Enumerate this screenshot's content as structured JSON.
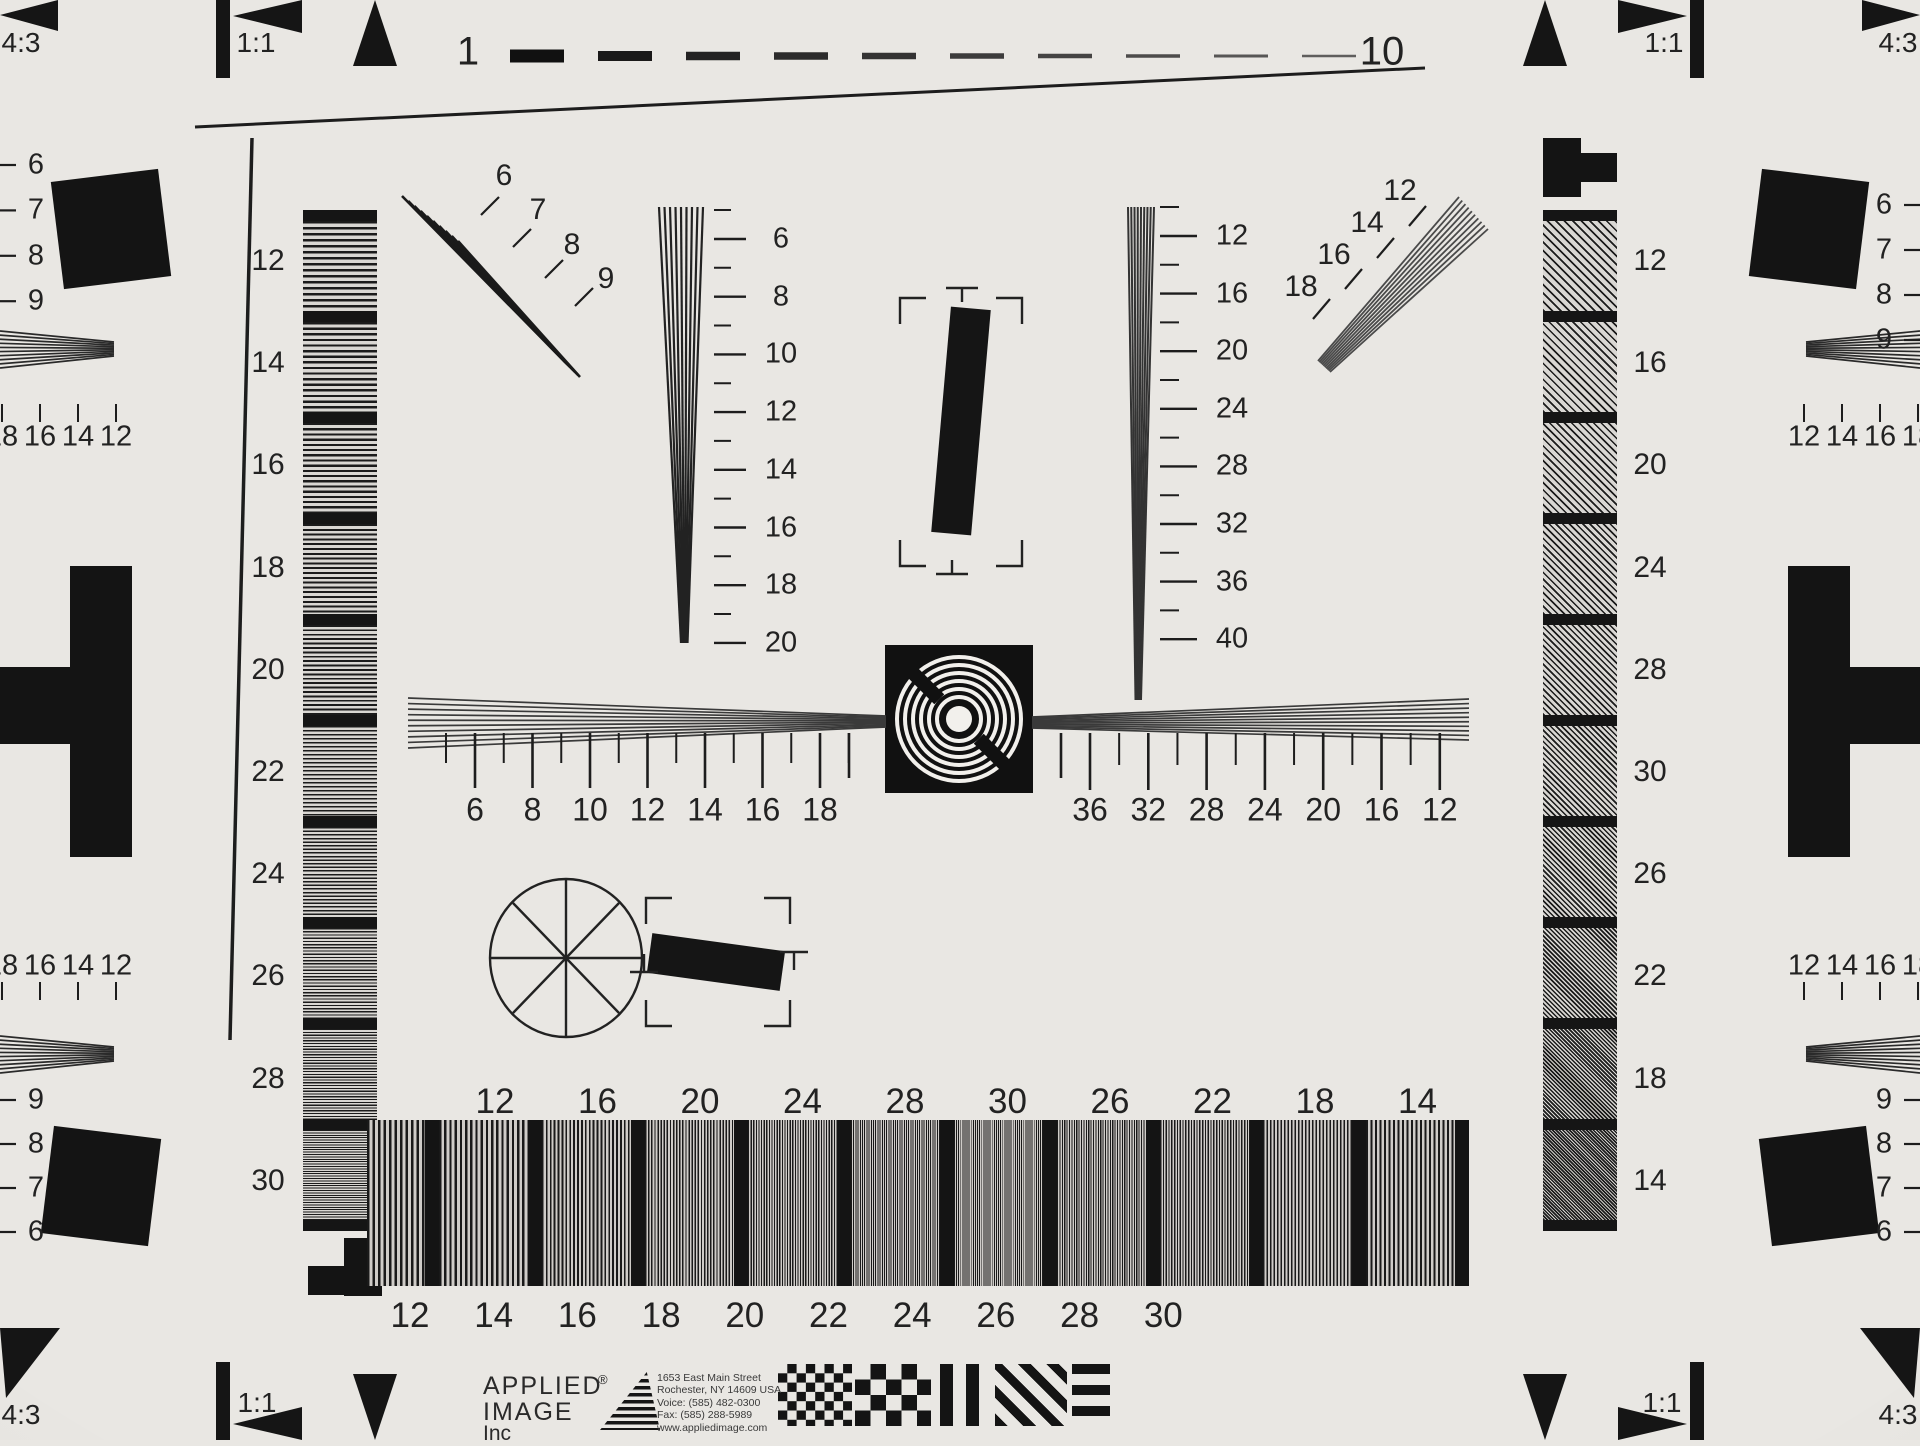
{
  "chart_name": "ISO resolution test chart",
  "corners": {
    "top_left": {
      "ratio": "4:3",
      "square": "1:1"
    },
    "top_right": {
      "ratio": "4:3",
      "square": "1:1"
    },
    "bottom_left": {
      "ratio": "4:3",
      "square": "1:1"
    },
    "bottom_right": {
      "ratio": "4:3",
      "square": "1:1"
    }
  },
  "top_scale": {
    "start": "1",
    "end": "10"
  },
  "left_strip": {
    "labels": [
      "12",
      "14",
      "16",
      "18",
      "20",
      "22",
      "24",
      "26",
      "28",
      "30"
    ]
  },
  "right_strip": {
    "labels": [
      "12",
      "16",
      "20",
      "24",
      "28",
      "30",
      "26",
      "22",
      "18",
      "14"
    ]
  },
  "left_wedge_scale": {
    "labels": [
      "6",
      "8",
      "10",
      "12",
      "14",
      "16",
      "18",
      "20"
    ]
  },
  "right_wedge_scale": {
    "labels": [
      "12",
      "16",
      "20",
      "24",
      "28",
      "32",
      "36",
      "40"
    ]
  },
  "fan_top_left": {
    "labels": [
      "6",
      "7",
      "8",
      "9"
    ]
  },
  "fan_top_right": {
    "labels": [
      "12",
      "14",
      "16",
      "18"
    ]
  },
  "center_ruler": {
    "left_labels": [
      "6",
      "8",
      "10",
      "12",
      "14",
      "16",
      "18"
    ],
    "right_labels": [
      "36",
      "32",
      "28",
      "24",
      "20",
      "16",
      "12"
    ]
  },
  "bottom_bar": {
    "top_labels": [
      "12",
      "16",
      "20",
      "24",
      "28",
      "30",
      "26",
      "22",
      "18",
      "14"
    ],
    "bottom_labels": [
      "12",
      "14",
      "16",
      "18",
      "20",
      "22",
      "24",
      "26",
      "28",
      "30"
    ]
  },
  "edges": {
    "left": {
      "top_column": [
        "6",
        "7",
        "8",
        "9"
      ],
      "row_upper": [
        "18",
        "16",
        "14",
        "12"
      ],
      "row_lower": [
        "18",
        "16",
        "14",
        "12"
      ],
      "bottom_column": [
        "9",
        "8",
        "7",
        "6"
      ]
    },
    "right": {
      "top_column": [
        "6",
        "7",
        "8",
        "9"
      ],
      "row_upper": [
        "12",
        "14",
        "16",
        "18"
      ],
      "row_lower": [
        "12",
        "14",
        "16",
        "18"
      ],
      "bottom_column": [
        "9",
        "8",
        "7",
        "6"
      ]
    }
  },
  "branding": {
    "company_line1": "APPLIED",
    "company_line2": "IMAGE",
    "company_line3": "Inc",
    "registered_mark": "®",
    "address_lines": [
      "1653 East Main Street",
      "Rochester, NY  14609  USA",
      "Voice:   (585) 482-0300",
      "Fax:      (585) 288-5989",
      "www.appliedimage.com"
    ]
  },
  "colors": {
    "background": "#e9e7e3",
    "ink": "#1a1a1a",
    "mid_gray": "#8a8a8a"
  }
}
